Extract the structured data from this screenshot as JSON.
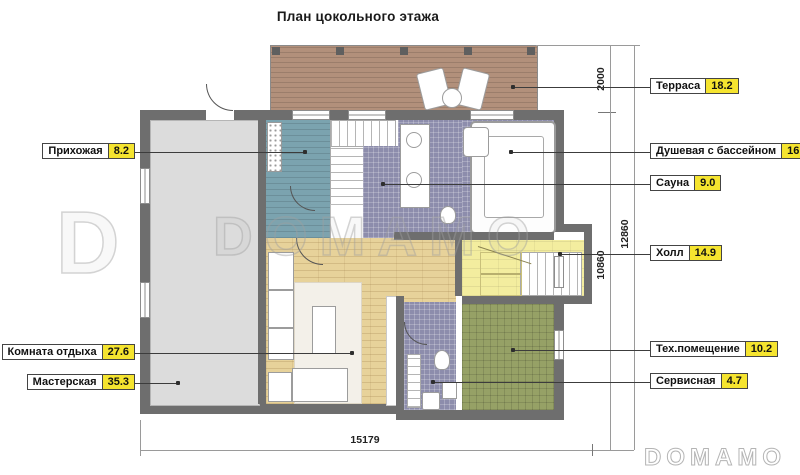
{
  "title": "План цокольного этажа",
  "rooms": [
    {
      "name": "Прихожая",
      "area": "8.2"
    },
    {
      "name": "Комната отдыха",
      "area": "27.6"
    },
    {
      "name": "Мастерская",
      "area": "35.3"
    },
    {
      "name": "Терраса",
      "area": "18.2"
    },
    {
      "name": "Душевая с бассейном",
      "area": "16.8"
    },
    {
      "name": "Сауна",
      "area": "9.0"
    },
    {
      "name": "Холл",
      "area": "14.9"
    },
    {
      "name": "Тех.помещение",
      "area": "10.2"
    },
    {
      "name": "Сервисная",
      "area": "4.7"
    }
  ],
  "dimensions": {
    "terrace_depth": "2000",
    "house_height": "10860",
    "total_height": "12860",
    "total_width": "15179"
  },
  "watermark": {
    "center": "DOMAMO",
    "left_fragment": "D",
    "corner_logo": "DOMAMO"
  },
  "colors": {
    "area_badge": "#f5e42f",
    "wall": "#6e6e6e"
  }
}
